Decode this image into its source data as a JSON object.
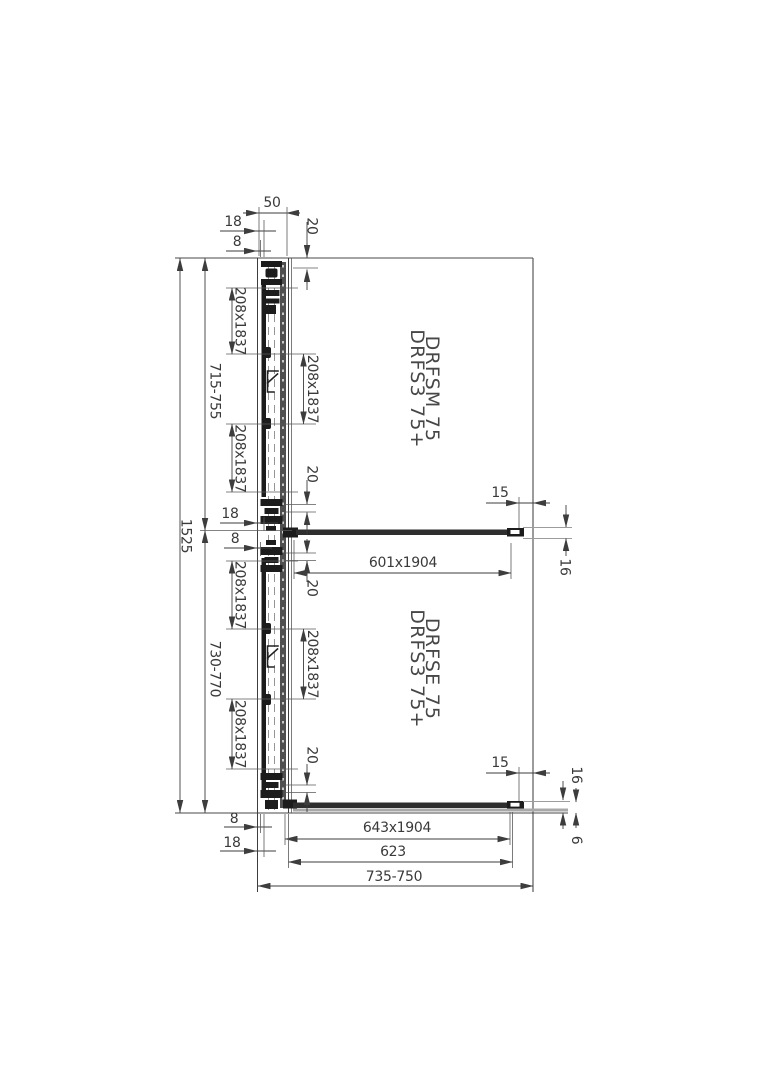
{
  "product_labels": {
    "top_unit": {
      "line1": "DRFS3 75+",
      "line2": "DRFSM 75"
    },
    "bottom_unit": {
      "line1": "DRFS3 75+",
      "line2": "DRFSE 75"
    }
  },
  "dimensions": {
    "total_height": "1525",
    "top_unit_height": "715-755",
    "bottom_unit_height": "730-770",
    "rail_width": "50",
    "offset_18": "18",
    "offset_8": "8",
    "gap_20": "20",
    "wall_gap_15": "15",
    "fixing_16": "16",
    "glass_thickness_6": "6",
    "door_leaf": "208x1837",
    "mid_panel_glass": "601x1904",
    "bottom_panel_glass": "643x1904",
    "bottom_panel_width": "623",
    "entry_width": "735-750"
  },
  "colors": {
    "background": "#ffffff",
    "line": "#3d3d3d",
    "glass_dark": "#2e2e2e",
    "gray_band": "#a8a8a8",
    "black_parts": "#1c1c1c"
  }
}
